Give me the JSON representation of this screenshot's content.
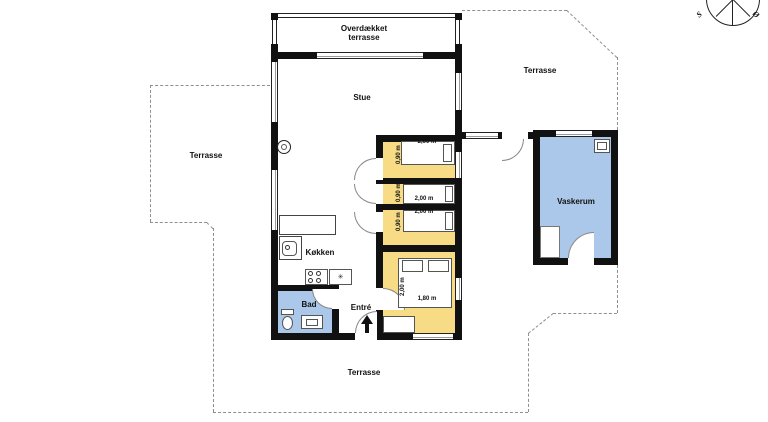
{
  "compass": {
    "south": "S",
    "east": "Ø"
  },
  "labels": {
    "covered_terrace_line1": "Overdækket",
    "covered_terrace_line2": "terrasse",
    "terrace_left": "Terrasse",
    "terrace_top_right": "Terrasse",
    "terrace_bottom": "Terrasse",
    "living_room": "Stue",
    "kitchen": "Køkken",
    "bathroom": "Bad",
    "entry": "Entré",
    "laundry_room": "Vaskerum"
  },
  "measurements": {
    "bed1_length": "2,00 m",
    "bed1_width": "0,90 m",
    "bed2_length": "2,00 m",
    "bed2_width": "0,90 m",
    "bed3_length": "2,00 m",
    "bed3_width": "0,90 m",
    "double_bed_length": "2,00 m",
    "double_bed_width": "1,80 m"
  },
  "symbols": {
    "freezer": "✳"
  },
  "colors": {
    "bedroom_fill": "#F8DC85",
    "wet_room_fill": "#ABC8EA",
    "wall": "#111111",
    "dashed_outline": "#8F8F8F"
  }
}
